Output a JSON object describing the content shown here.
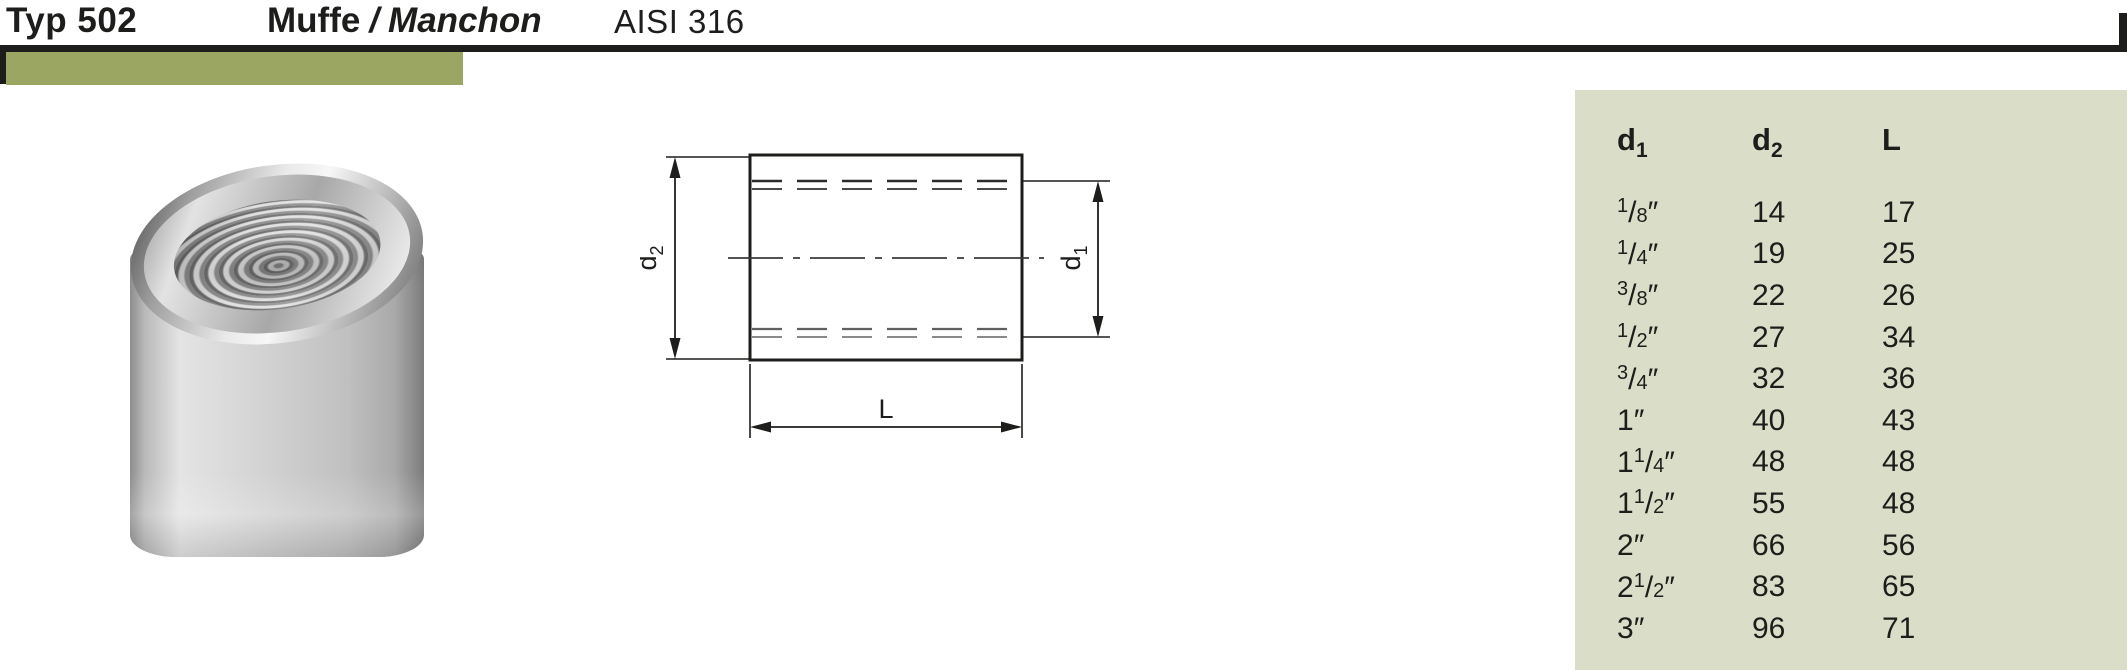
{
  "header": {
    "type_label": "Typ 502",
    "name_de": "Muffe",
    "separator": "/",
    "name_fr": "Manchon",
    "material": "AISI 316"
  },
  "drawing": {
    "label_d2": {
      "base": "d",
      "sub": "2"
    },
    "label_d1": {
      "base": "d",
      "sub": "1"
    },
    "label_length": "L"
  },
  "table": {
    "unit": "″",
    "headers": [
      {
        "base": "d",
        "sub": "1"
      },
      {
        "base": "d",
        "sub": "2"
      },
      {
        "base": "L",
        "sub": ""
      }
    ],
    "rows": [
      {
        "d1": {
          "whole": "",
          "num": "1",
          "den": "8"
        },
        "d2": "14",
        "l": "17"
      },
      {
        "d1": {
          "whole": "",
          "num": "1",
          "den": "4"
        },
        "d2": "19",
        "l": "25"
      },
      {
        "d1": {
          "whole": "",
          "num": "3",
          "den": "8"
        },
        "d2": "22",
        "l": "26"
      },
      {
        "d1": {
          "whole": "",
          "num": "1",
          "den": "2"
        },
        "d2": "27",
        "l": "34"
      },
      {
        "d1": {
          "whole": "",
          "num": "3",
          "den": "4"
        },
        "d2": "32",
        "l": "36"
      },
      {
        "d1": {
          "whole": "1",
          "num": "",
          "den": ""
        },
        "d2": "40",
        "l": "43"
      },
      {
        "d1": {
          "whole": "1",
          "num": "1",
          "den": "4"
        },
        "d2": "48",
        "l": "48"
      },
      {
        "d1": {
          "whole": "1",
          "num": "1",
          "den": "2"
        },
        "d2": "55",
        "l": "48"
      },
      {
        "d1": {
          "whole": "2",
          "num": "",
          "den": ""
        },
        "d2": "66",
        "l": "56"
      },
      {
        "d1": {
          "whole": "2",
          "num": "1",
          "den": "2"
        },
        "d2": "83",
        "l": "65"
      },
      {
        "d1": {
          "whole": "3",
          "num": "",
          "den": ""
        },
        "d2": "96",
        "l": "71"
      }
    ]
  },
  "colors": {
    "accent_olive": "#9aa662",
    "table_background": "#dadec8",
    "line_black": "#1d1d1b"
  }
}
